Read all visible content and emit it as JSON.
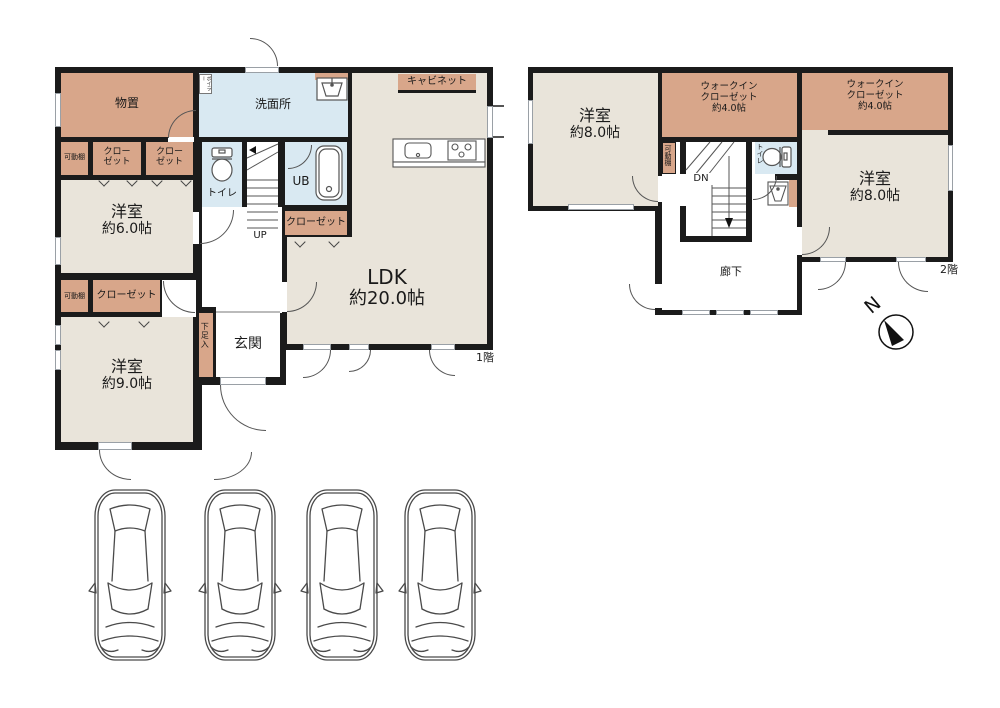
{
  "floor1": {
    "label": "1階",
    "rooms": {
      "storage": "物置",
      "washroom": "洗面所",
      "boiler": "ボイラー",
      "cabinet": "キャビネット",
      "movable_shelf": "可動棚",
      "closet_line1": "クロー",
      "closet_line2": "ゼット",
      "closet": "クローゼット",
      "bedroom6": {
        "name": "洋室",
        "size": "約6.0帖"
      },
      "toilet": "トイレ",
      "unit_bath": "UB",
      "stairs": "UP",
      "ldk": {
        "name": "LDK",
        "size": "約20.0帖"
      },
      "entrance": "玄関",
      "shoe_cupboard": "下足入",
      "bedroom9": {
        "name": "洋室",
        "size": "約9.0帖"
      }
    }
  },
  "floor2": {
    "label": "2階",
    "rooms": {
      "bedroom8": {
        "name": "洋室",
        "size": "約8.0帖"
      },
      "walkin_closet": {
        "line1": "ウォークイン",
        "line2": "クローゼット",
        "line3": "約4.0帖"
      },
      "movable_shelf": "可動棚",
      "stairs": "DN",
      "toilet": "トイレ",
      "corridor": "廊下"
    }
  },
  "compass": {
    "north_label": "N"
  },
  "parking": {
    "spaces": 4
  },
  "colors": {
    "wall": "#1b1b1b",
    "closet_tan": "#d8a68a",
    "room_beige": "#e9e4da",
    "water_blue": "#d9e9f2",
    "background": "#ffffff"
  }
}
